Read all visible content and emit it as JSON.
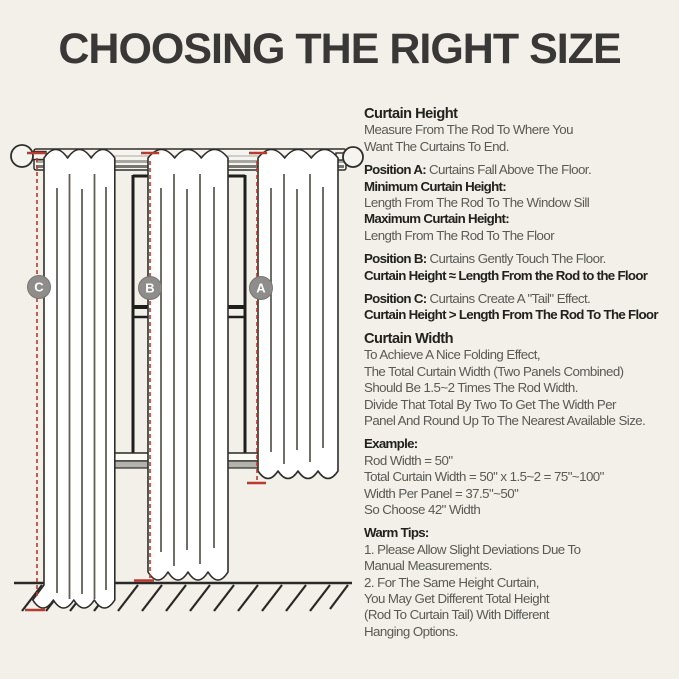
{
  "title": "CHOOSING THE RIGHT SIZE",
  "colors": {
    "background": "#f2f0e8",
    "accent_red": "#b93a2e",
    "badge_gray": "#8e8d8b",
    "heading_text": "#22211d",
    "body_text": "#5b5954"
  },
  "diagram": {
    "badges": [
      {
        "label": "C"
      },
      {
        "label": "B"
      },
      {
        "label": "A"
      }
    ]
  },
  "sections": [
    {
      "name": "curtain-height",
      "lines": [
        [
          {
            "t": "Curtain Height",
            "w": "head"
          }
        ],
        [
          {
            "t": "Measure From The Rod To Where You",
            "w": "reg"
          }
        ],
        [
          {
            "t": "Want The Curtains To End.",
            "w": "reg"
          }
        ]
      ]
    },
    {
      "name": "position-a",
      "lines": [
        [
          {
            "t": "Position A: ",
            "w": "bold"
          },
          {
            "t": "Curtains Fall Above The Floor.",
            "w": "reg"
          }
        ],
        [
          {
            "t": "Minimum Curtain Height:",
            "w": "bold"
          }
        ],
        [
          {
            "t": "Length From The Rod To The Window Sill",
            "w": "reg"
          }
        ],
        [
          {
            "t": "Maximum Curtain Height:",
            "w": "bold"
          }
        ],
        [
          {
            "t": "Length From The Rod To The Floor",
            "w": "reg"
          }
        ]
      ]
    },
    {
      "name": "position-b",
      "lines": [
        [
          {
            "t": "Position B: ",
            "w": "bold"
          },
          {
            "t": "Curtains Gently Touch The Floor.",
            "w": "reg"
          }
        ],
        [
          {
            "t": "Curtain Height ≈ Length From the Rod to the Floor",
            "w": "bold"
          }
        ]
      ]
    },
    {
      "name": "position-c",
      "lines": [
        [
          {
            "t": "Position C: ",
            "w": "bold"
          },
          {
            "t": "Curtains Create A \"Tail\" Effect.",
            "w": "reg"
          }
        ],
        [
          {
            "t": "Curtain Height > Length From The Rod To The Floor",
            "w": "bold"
          }
        ]
      ]
    },
    {
      "name": "curtain-width",
      "lines": [
        [
          {
            "t": "Curtain Width",
            "w": "head"
          }
        ],
        [
          {
            "t": "To Achieve A Nice Folding Effect,",
            "w": "reg"
          }
        ],
        [
          {
            "t": "The Total Curtain Width (Two Panels Combined)",
            "w": "reg"
          }
        ],
        [
          {
            "t": "Should Be 1.5~2 Times The Rod Width.",
            "w": "reg"
          }
        ],
        [
          {
            "t": "Divide That Total By Two To Get The Width Per",
            "w": "reg"
          }
        ],
        [
          {
            "t": "Panel And Round Up To The Nearest Available Size.",
            "w": "reg"
          }
        ]
      ]
    },
    {
      "name": "example",
      "lines": [
        [
          {
            "t": "Example:",
            "w": "bold"
          }
        ],
        [
          {
            "t": "Rod Width = 50\"",
            "w": "reg"
          }
        ],
        [
          {
            "t": "Total Curtain Width = 50\" x 1.5~2 = 75\"~100\"",
            "w": "reg"
          }
        ],
        [
          {
            "t": "Width Per Panel = 37.5\"~50\"",
            "w": "reg"
          }
        ],
        [
          {
            "t": "So Choose 42\" Width",
            "w": "reg"
          }
        ]
      ]
    },
    {
      "name": "warm-tips",
      "lines": [
        [
          {
            "t": "Warm Tips:",
            "w": "bold"
          }
        ],
        [
          {
            "t": "1. Please Allow Slight Deviations Due To",
            "w": "reg"
          }
        ],
        [
          {
            "t": "Manual Measurements.",
            "w": "reg"
          }
        ],
        [
          {
            "t": "2. For The Same Height Curtain,",
            "w": "reg"
          }
        ],
        [
          {
            "t": "You May Get Different Total Height",
            "w": "reg"
          }
        ],
        [
          {
            "t": "(Rod To Curtain Tail) With Different",
            "w": "reg"
          }
        ],
        [
          {
            "t": "Hanging Options.",
            "w": "reg"
          }
        ]
      ]
    }
  ]
}
